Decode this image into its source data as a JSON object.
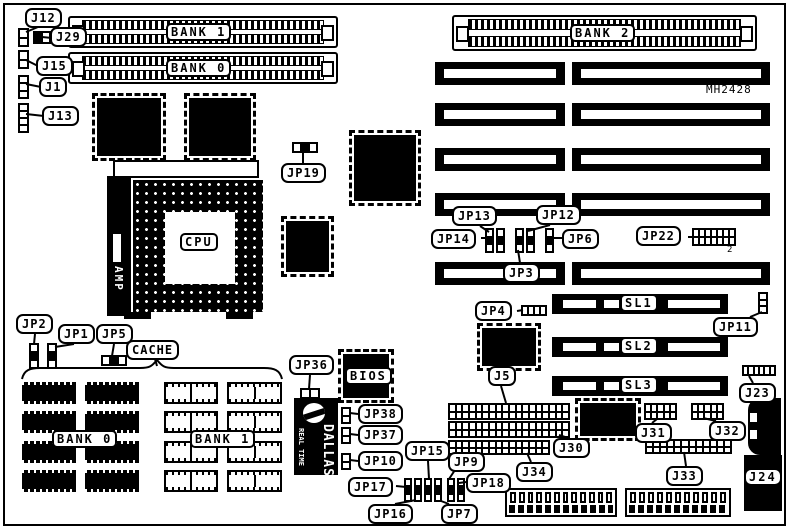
{
  "diagram": {
    "board_id": "MH2428",
    "colors": {
      "ink": "#000000",
      "paper": "#ffffff"
    },
    "memory": {
      "bank1_top": "BANK 1",
      "bank0_top": "BANK 0",
      "bank2": "BANK 2",
      "cache_bank0": "BANK 0",
      "cache_bank1": "BANK 1"
    },
    "cpu": {
      "label": "CPU",
      "lever_brand": "AMP"
    },
    "cache_label": "CACHE",
    "bios_label": "BIOS",
    "rtc": {
      "line1": "DALLAS",
      "line2": "REAL TIME"
    },
    "slots": {
      "sl1": "SL1",
      "sl2": "SL2",
      "sl3": "SL3"
    },
    "jumpers": {
      "j12": "J12",
      "j29": "J29",
      "j15": "J15",
      "j1": "J1",
      "j13": "J13",
      "jp19": "JP19",
      "jp13": "JP13",
      "jp12": "JP12",
      "jp14": "JP14",
      "jp6": "JP6",
      "jp3": "JP3",
      "jp22": "JP22",
      "jp22_pin": "2",
      "jp4": "JP4",
      "jp11": "JP11",
      "jp2": "JP2",
      "jp1": "JP1",
      "jp5": "JP5",
      "jp36": "JP36",
      "jp38": "JP38",
      "jp37": "JP37",
      "jp10": "JP10",
      "jp15": "JP15",
      "jp17": "JP17",
      "jp16": "JP16",
      "jp7": "JP7",
      "jp9": "JP9",
      "jp18": "JP18",
      "j5": "J5",
      "j30": "J30",
      "j34": "J34",
      "j31": "J31",
      "j32": "J32",
      "j33": "J33",
      "j23": "J23",
      "j24": "J24"
    }
  }
}
